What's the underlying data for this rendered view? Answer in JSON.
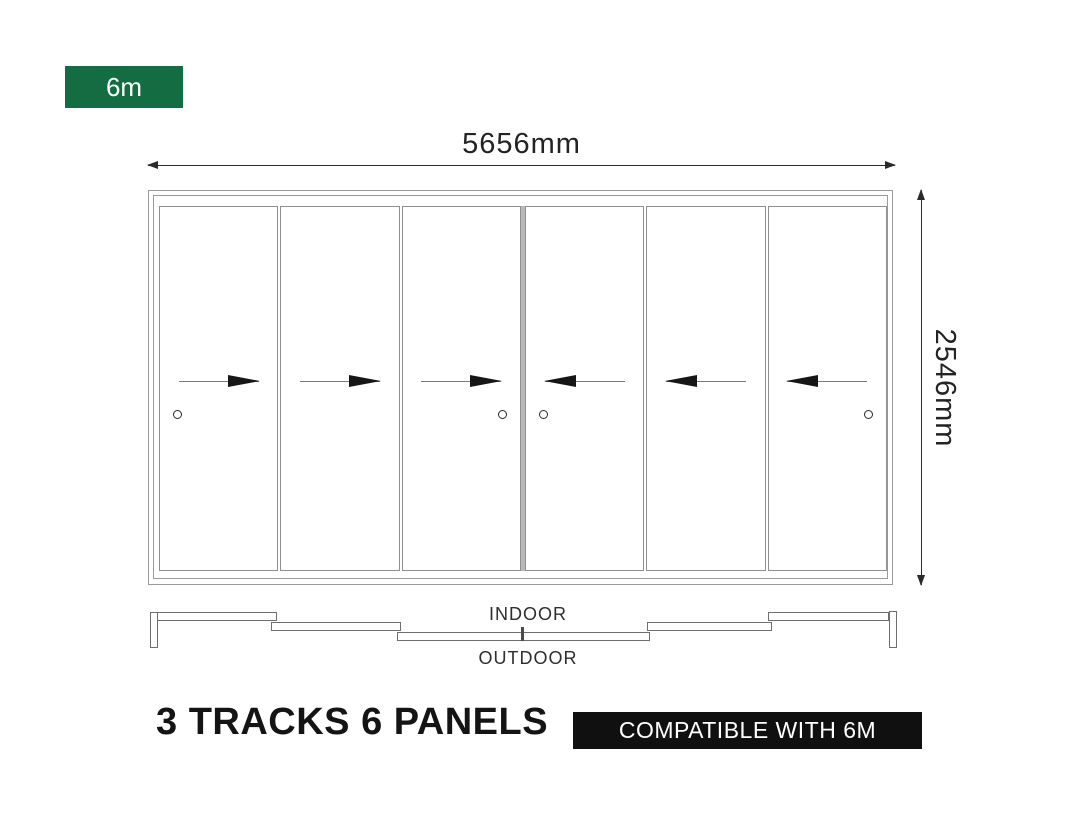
{
  "size_badge": {
    "label": "6m",
    "bg_color": "#136c42"
  },
  "dimensions": {
    "width_label": "5656mm",
    "height_label": "2546mm"
  },
  "panel_diagram": {
    "panels": [
      {
        "name": "panel-1",
        "arrow": "right",
        "handle": "left"
      },
      {
        "name": "panel-2",
        "arrow": "right",
        "handle": "none"
      },
      {
        "name": "panel-3",
        "arrow": "right",
        "handle": "right"
      },
      {
        "name": "panel-4",
        "arrow": "left",
        "handle": "left"
      },
      {
        "name": "panel-5",
        "arrow": "left",
        "handle": "none"
      },
      {
        "name": "panel-6",
        "arrow": "left",
        "handle": "right"
      }
    ]
  },
  "track_plan": {
    "indoor_label": "INDOOR",
    "outdoor_label": "OUTDOOR"
  },
  "footer": {
    "title": "3 TRACKS 6 PANELS",
    "compatibility_badge": "COMPATIBLE WITH 6M",
    "badge_bg_color": "#101010"
  }
}
